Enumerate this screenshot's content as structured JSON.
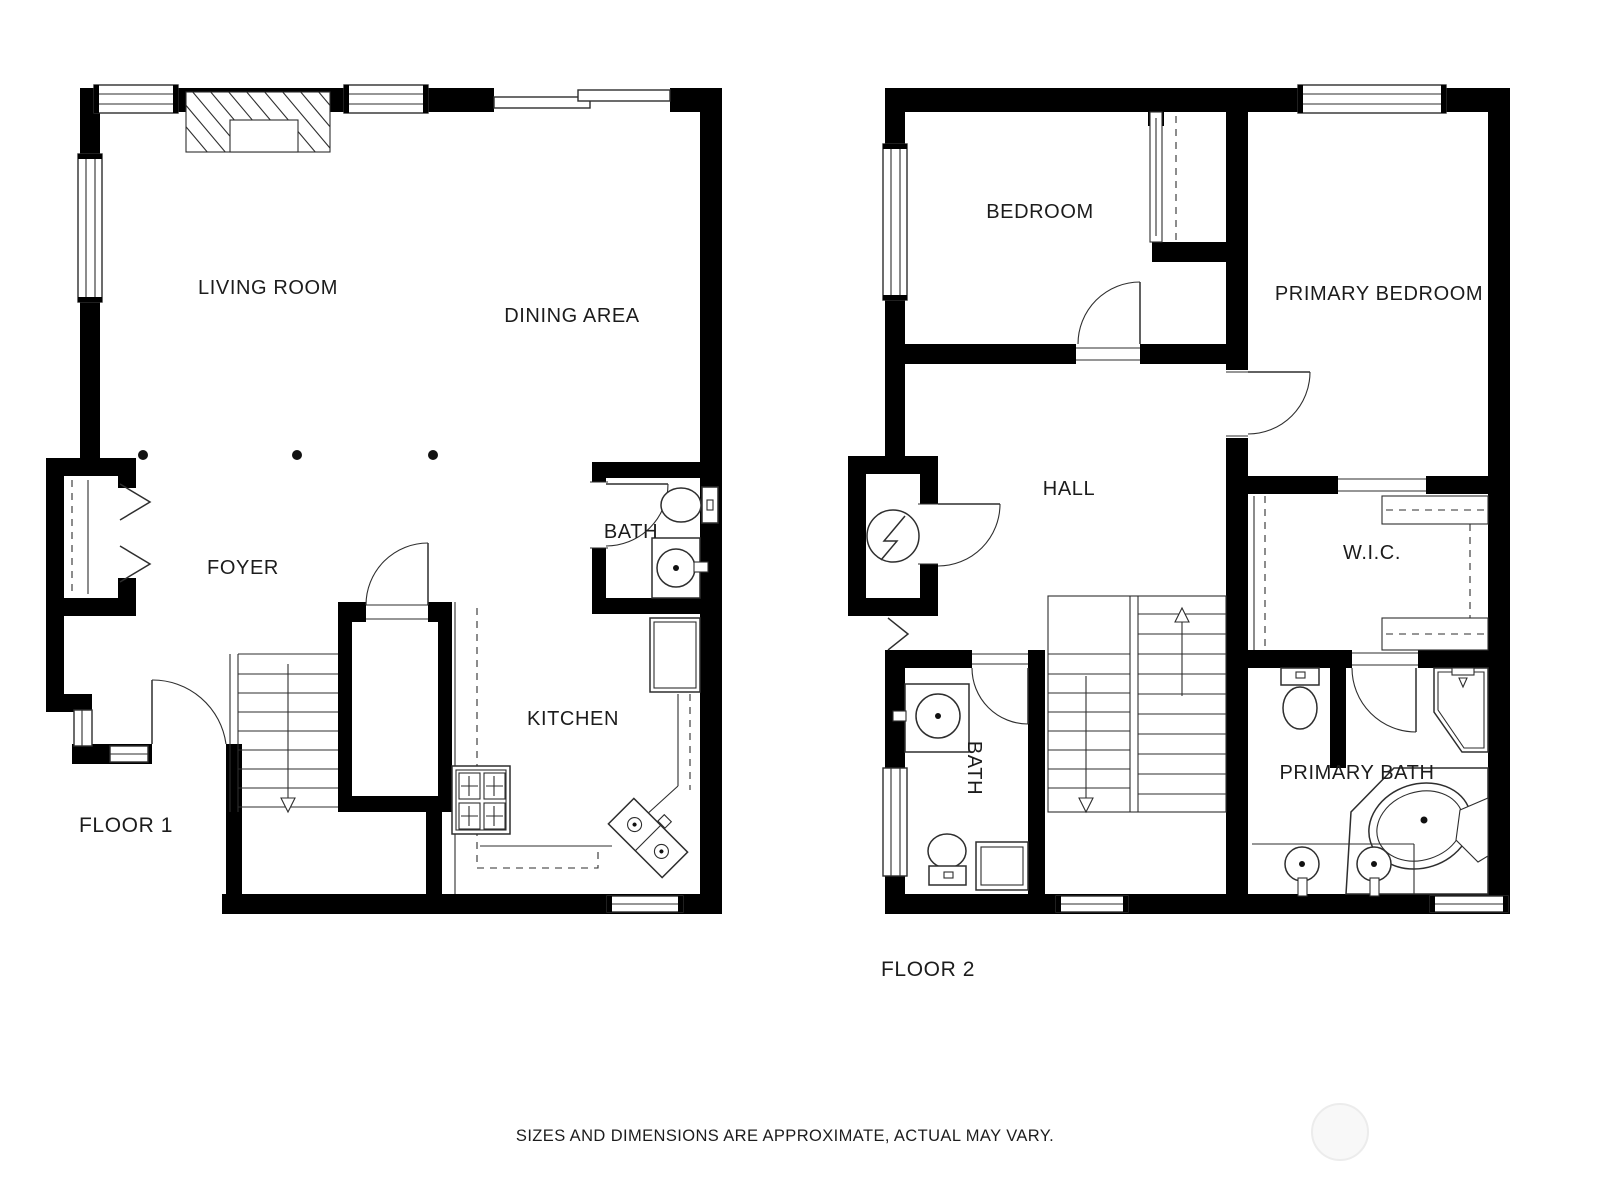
{
  "disclaimer": {
    "text": "SIZES AND DIMENSIONS ARE APPROXIMATE, ACTUAL MAY VARY."
  },
  "colors": {
    "background": "#ffffff",
    "walls": "#000000",
    "lines": "#2e2e2e",
    "text": "#1c1c1c",
    "watermark_stroke": "#ececec",
    "watermark_fill": "#f8f8f8"
  },
  "floor1": {
    "label": "FLOOR 1",
    "rooms": [
      {
        "id": "living-room",
        "label": "LIVING ROOM"
      },
      {
        "id": "dining-area",
        "label": "DINING AREA"
      },
      {
        "id": "foyer",
        "label": "FOYER"
      },
      {
        "id": "bath",
        "label": "BATH"
      },
      {
        "id": "kitchen",
        "label": "KITCHEN"
      }
    ]
  },
  "floor2": {
    "label": "FLOOR 2",
    "rooms": [
      {
        "id": "bedroom",
        "label": "BEDROOM"
      },
      {
        "id": "primary-bedroom",
        "label": "PRIMARY BEDROOM"
      },
      {
        "id": "hall",
        "label": "HALL"
      },
      {
        "id": "wic",
        "label": "W.I.C."
      },
      {
        "id": "bath",
        "label": "BATH"
      },
      {
        "id": "primary-bath",
        "label": "PRIMARY BATH"
      }
    ]
  }
}
